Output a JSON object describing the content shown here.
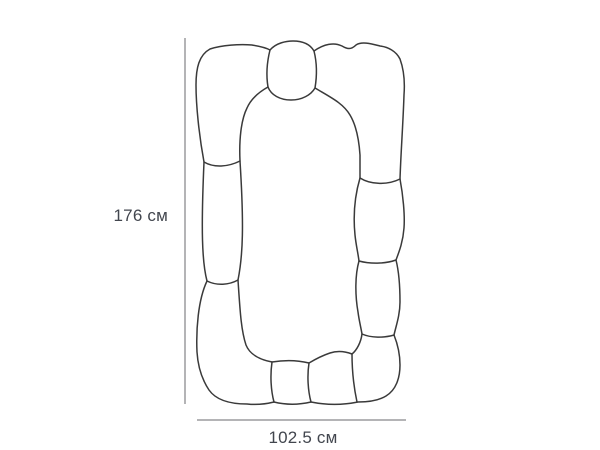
{
  "diagram": {
    "title": "product-dimension-diagram",
    "subject": "organic stone-frame mirror outline",
    "height_label": "176 см",
    "width_label": "102.5 см",
    "height_value_cm": 176,
    "width_value_cm": 102.5
  },
  "colors": {
    "background": "#ffffff",
    "outline": "#3a3a3a",
    "dimension_line": "#b4b4b6",
    "label_text": "#42464e"
  }
}
